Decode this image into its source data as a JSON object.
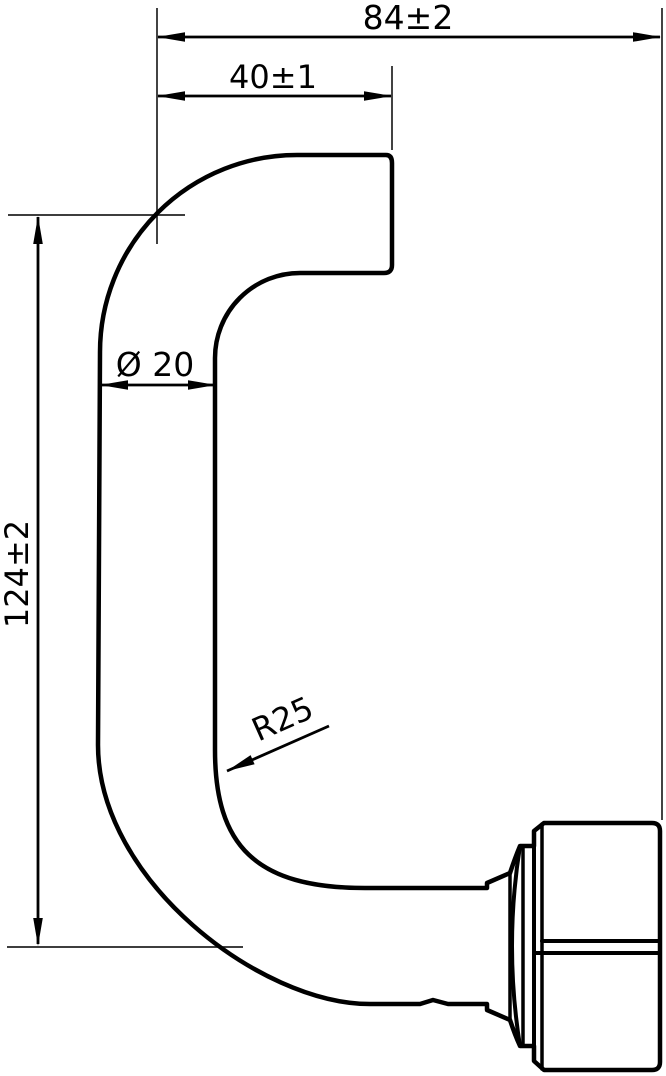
{
  "drawing": {
    "type": "technical-drawing-door-handle",
    "colors": {
      "background": "#ffffff",
      "outline": "#000000",
      "dimension_line": "#000000",
      "extension_line": "#222222"
    },
    "dimensions": {
      "overall_width": {
        "label": "84±2"
      },
      "neck_offset": {
        "label": "40±1"
      },
      "tube_diameter": {
        "label": "Ø 20"
      },
      "overall_height": {
        "label": "124±2"
      },
      "bend_radius": {
        "label": "R25"
      }
    }
  }
}
